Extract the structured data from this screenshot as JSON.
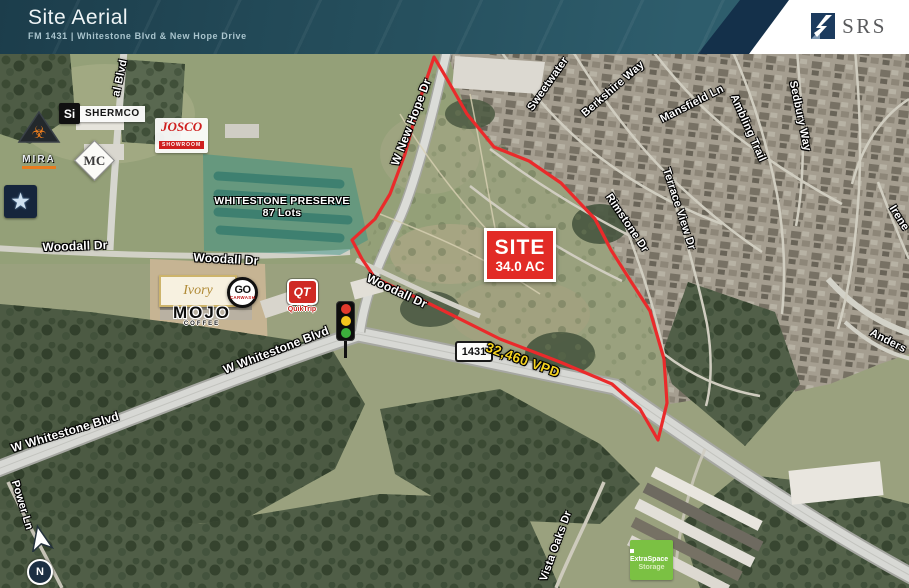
{
  "header": {
    "title": "Site Aerial",
    "subtitle": "FM 1431 | Whitestone Blvd & New Hope Drive",
    "brand": "SRS"
  },
  "site_callout": {
    "label": "SITE",
    "acreage": "34.0 AC"
  },
  "traffic": {
    "route_shield": "1431",
    "volume": "32,460 VPD"
  },
  "preserve": {
    "name": "WHITESTONE PRESERVE",
    "lots": "87 Lots"
  },
  "compass": {
    "north": "N"
  },
  "streets": {
    "al_blvd": "al Blvd",
    "new_hope": "W New Hope Dr",
    "sweetwater": "Sweetwater",
    "berkshire": "Berkshire Way",
    "mansfield": "Mansfield Ln",
    "ambling": "Ambling Trail",
    "sedbury": "Sedbury Way",
    "irene": "Irene",
    "rimstone": "Rimstone Dr",
    "terrace_view": "Terrace View Dr",
    "woodall_left": "Woodall Dr",
    "woodall_mid": "Woodall Dr",
    "woodall_ne": "Woodall Dr",
    "whitestone_upper": "W Whitestone Blvd",
    "whitestone_lower": "W Whitestone Blvd",
    "power_ln": "Power Ln",
    "vista_oaks": "Vista Oaks Dr",
    "anderson": "Anders"
  },
  "businesses": {
    "shermco": {
      "icon": "Si",
      "name": "SHERMCO"
    },
    "josco": {
      "name": "JOSCO",
      "sub": "SHOWROOM"
    },
    "mc": {
      "initials": "MC"
    },
    "mira": {
      "name": "MIRA",
      "icon": "☣"
    },
    "star": {
      "icon": "★"
    },
    "ivory": {
      "name": "Ivory"
    },
    "mojo": {
      "name": "MOJO",
      "sub": "COFFEE"
    },
    "go": {
      "name": "GO",
      "sub": "CARWASH"
    },
    "qt": {
      "initials": "QT",
      "name": "QuikTrip"
    },
    "extraspace": {
      "name": "ExtraSpace",
      "sub": "Storage"
    }
  },
  "colors": {
    "boundary_red": "#ea2a2b",
    "site_box_red": "#e22b26",
    "vpd_yellow": "#f6d41f",
    "preserve_teal": "#2f8f86",
    "header_teal": "#26505e",
    "header_navy_band": "#14304a",
    "srs_navy": "#1c3b5e",
    "extraspace_green": "#7bc143",
    "qt_red": "#cf2a24"
  }
}
